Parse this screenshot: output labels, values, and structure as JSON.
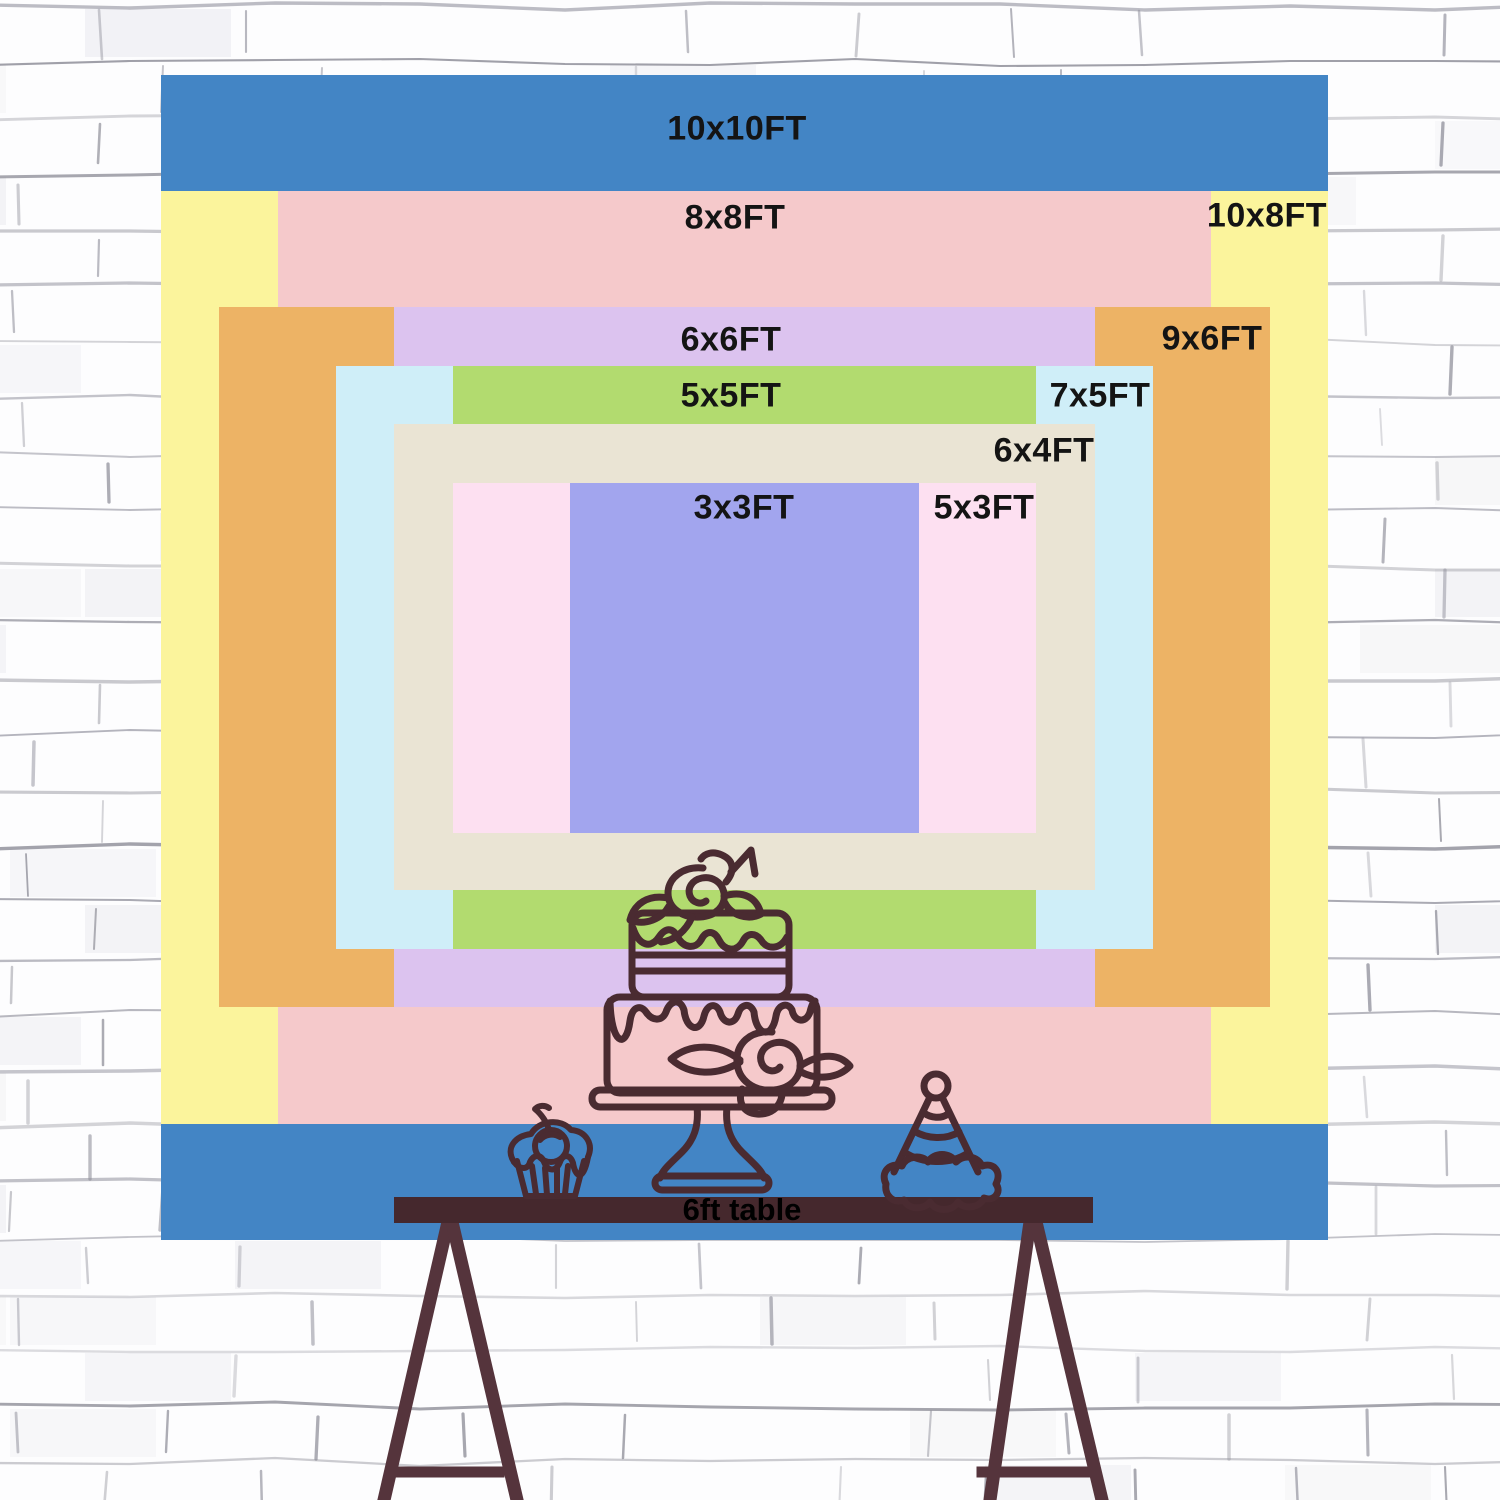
{
  "chart": {
    "description_label_suffix": "FT",
    "label_color": "#141414",
    "sizes": [
      {
        "label": "10x10FT",
        "width_ft": 10,
        "height_ft": 10,
        "color": "#4385c5"
      },
      {
        "label": "10x8FT",
        "width_ft": 10,
        "height_ft": 8,
        "color": "#fbf49c"
      },
      {
        "label": "8x8FT",
        "width_ft": 8,
        "height_ft": 8,
        "color": "#f5c9cb"
      },
      {
        "label": "9x6FT",
        "width_ft": 9,
        "height_ft": 6,
        "color": "#edb365"
      },
      {
        "label": "6x6FT",
        "width_ft": 6,
        "height_ft": 6,
        "color": "#dcc3ef"
      },
      {
        "label": "7x5FT",
        "width_ft": 7,
        "height_ft": 5,
        "color": "#cfeef8"
      },
      {
        "label": "5x5FT",
        "width_ft": 5,
        "height_ft": 5,
        "color": "#b2db6f"
      },
      {
        "label": "6x4FT",
        "width_ft": 6,
        "height_ft": 4,
        "color": "#eae4d4"
      },
      {
        "label": "5x3FT",
        "width_ft": 5,
        "height_ft": 3,
        "color": "#fde0f1"
      },
      {
        "label": "3x3FT",
        "width_ft": 3,
        "height_ft": 3,
        "color": "#a2a5ee"
      }
    ]
  },
  "table": {
    "label": "6ft table",
    "top_color": "#45282d",
    "legs_color": "#55343c"
  },
  "art": {
    "line_color": "#4a2b31",
    "items": [
      "two-tier-cake-on-stand",
      "cupcake-with-cherry",
      "party-hat"
    ]
  },
  "wall": {
    "background": "#fdfdfe",
    "line_color": "#8e8e99",
    "brick_shade": "#efeff3"
  }
}
